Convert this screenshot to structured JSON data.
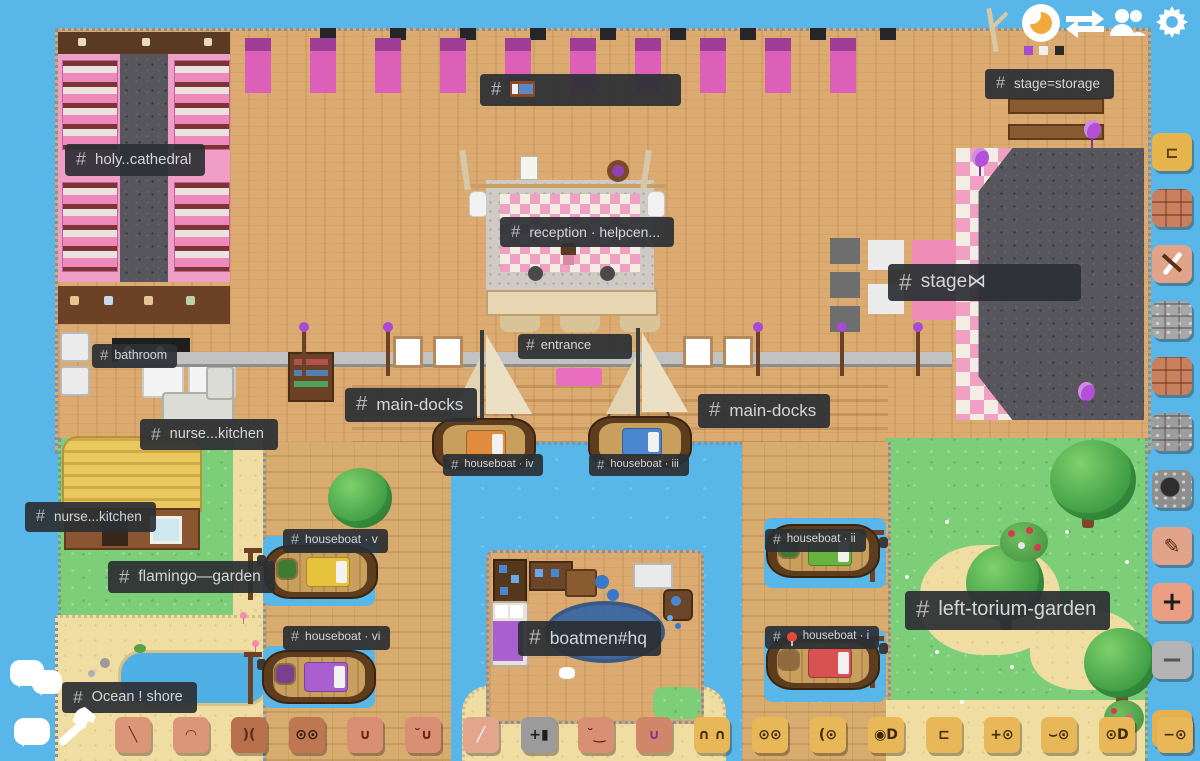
{
  "hash": "#",
  "topbar": {
    "buttons": [
      {
        "name": "night-mode",
        "icon": "crescent-moon-icon"
      },
      {
        "name": "map-swap",
        "icon": "transfer-arrows-icon"
      },
      {
        "name": "members",
        "icon": "people-icon"
      },
      {
        "name": "settings",
        "icon": "gear-icon"
      }
    ]
  },
  "map": {
    "labels": [
      {
        "id": "holy-cathedral",
        "text": "holy..cathedral"
      },
      {
        "id": "bedroom",
        "text": "🛏",
        "icon": "bed-emoji"
      },
      {
        "id": "stage-storage",
        "text": "stage=storage"
      },
      {
        "id": "reception-helpcenter",
        "text": "reception · helpcen..."
      },
      {
        "id": "stage",
        "text": "stage⋈"
      },
      {
        "id": "bathroom",
        "text": "bathroom"
      },
      {
        "id": "nurse-kitchen",
        "text": "nurse...kitchen"
      },
      {
        "id": "entrance",
        "text": "entrance"
      },
      {
        "id": "main-docks-left",
        "text": "main-docks"
      },
      {
        "id": "main-docks-right",
        "text": "main-docks"
      },
      {
        "id": "houseboat-iv",
        "text": "houseboat · iv"
      },
      {
        "id": "houseboat-iii",
        "text": "houseboat · iii"
      },
      {
        "id": "nurse-kitchen-west",
        "text": "nurse...kitchen"
      },
      {
        "id": "houseboat-v",
        "text": "houseboat · v"
      },
      {
        "id": "flamingo-garden",
        "text": "flamingo—garden"
      },
      {
        "id": "houseboat-ii",
        "text": "houseboat · ii"
      },
      {
        "id": "left-torium-garden",
        "text": "left-torium-garden"
      },
      {
        "id": "houseboat-vi",
        "text": "houseboat · vi"
      },
      {
        "id": "boatmen-hq",
        "text": "boatmen#hq"
      },
      {
        "id": "houseboat-i",
        "text": "houseboat · i",
        "emoji": "📍"
      },
      {
        "id": "ocean-shore",
        "text": "Ocean ! shore"
      }
    ],
    "boats": [
      {
        "id": "houseboat-iv",
        "type": "sailboat",
        "bed_color": "#e08b3e"
      },
      {
        "id": "houseboat-iii",
        "type": "sailboat",
        "bed_color": "#4a86cf"
      },
      {
        "id": "houseboat-v",
        "type": "rowboat",
        "bed_color": "#e6c23c"
      },
      {
        "id": "houseboat-ii",
        "type": "rowboat",
        "bed_color": "#67b33e"
      },
      {
        "id": "houseboat-vi",
        "type": "rowboat",
        "bed_color": "#a95fd0"
      },
      {
        "id": "houseboat-i",
        "type": "rowboat",
        "bed_color": "#d95252"
      }
    ]
  },
  "left_toolbar": {
    "buttons": [
      {
        "name": "chat-threads",
        "icon": "double-speech-bubble-icon"
      },
      {
        "name": "chat",
        "icon": "speech-bubble-icon"
      },
      {
        "name": "build-tool",
        "icon": "hammer-icon"
      }
    ]
  },
  "right_toolbar": {
    "buttons": [
      {
        "name": "active-tile",
        "glyph": "⊏",
        "color": "#e6b54d"
      },
      {
        "name": "brick-tile",
        "glyph": "",
        "color": "#c8805f"
      },
      {
        "name": "pickaxe-tile",
        "glyph": "",
        "color": "#e2a38b"
      },
      {
        "name": "stone-tile",
        "glyph": "",
        "color": "#a7a7a7"
      },
      {
        "name": "brick-tile-2",
        "glyph": "",
        "color": "#c8805f"
      },
      {
        "name": "stone-tile-2",
        "glyph": "",
        "color": "#9d9d9d"
      },
      {
        "name": "rubble-tile",
        "glyph": "",
        "color": "#8e8e8e"
      },
      {
        "name": "sign-tile",
        "glyph": "✎",
        "color": "#e2a38b"
      },
      {
        "name": "zoom-in",
        "glyph": "+",
        "color": "#eb9f82"
      },
      {
        "name": "zoom-out",
        "glyph": "−",
        "color": "#b4b4b4"
      },
      {
        "name": "face-tile",
        "glyph": "-D",
        "color": "#e6b04e"
      }
    ]
  },
  "bottom_toolbar": {
    "tiles": [
      {
        "name": "leaf-stroke-tile",
        "color": "#db9579",
        "glyph": "╲",
        "gc": "#6b2a18"
      },
      {
        "name": "arc-face-tile",
        "color": "#db9579",
        "glyph": "◠",
        "gc": "#6b2a18"
      },
      {
        "name": "bark-tile",
        "color": "#b76f4c",
        "glyph": ")(",
        "gc": "#5e2c16"
      },
      {
        "name": "owl-eyes-face-tile",
        "color": "#bd7852",
        "glyph": "⊙⊙",
        "gc": "#2e1608"
      },
      {
        "name": "grin-face-tile",
        "color": "#d98f73",
        "glyph": "∪",
        "gc": "#5e2414"
      },
      {
        "name": "wink-face-tile",
        "color": "#d98f73",
        "glyph": "˘∪",
        "gc": "#5e2414"
      },
      {
        "name": "bandage-face-tile",
        "color": "#e3a68c",
        "glyph": "╱",
        "gc": "#ffffff"
      },
      {
        "name": "anvil-counter-tile",
        "color": "#9b9b9b",
        "glyph": "+▮",
        "gc": "#1d1d1d"
      },
      {
        "name": "smirk-face-tile",
        "color": "#d98f73",
        "glyph": "˘‿",
        "gc": "#5e2414"
      },
      {
        "name": "tongue-face-tile",
        "color": "#cf8669",
        "glyph": "∪",
        "gc": "#8a2f8f"
      },
      {
        "name": "calm-face-tile",
        "color": "#e8b758",
        "glyph": "∩ ∩",
        "gc": "#3f2a08"
      },
      {
        "name": "round-eyes-face-tile",
        "color": "#e8b758",
        "glyph": "⊙⊙",
        "gc": "#3f2a08"
      },
      {
        "name": "wink-eye-face-tile",
        "color": "#e8b758",
        "glyph": "(⊙",
        "gc": "#3f2a08"
      },
      {
        "name": "big-eyes-face-tile",
        "color": "#e8b758",
        "glyph": "◉D",
        "gc": "#3f2a08"
      },
      {
        "name": "blank-face-tile",
        "color": "#e8b758",
        "glyph": "⊏",
        "gc": "#3f2a08"
      },
      {
        "name": "glance-face-tile",
        "color": "#e8b758",
        "glyph": "+⊙",
        "gc": "#3f2a08"
      },
      {
        "name": "teary-face-tile",
        "color": "#e8b758",
        "glyph": "⌣⊙",
        "gc": "#3f2a08"
      },
      {
        "name": "happy-face-tile",
        "color": "#e8b758",
        "glyph": "⊙D",
        "gc": "#3f2a08"
      },
      {
        "name": "sleepy-face-tile",
        "color": "#e8b758",
        "glyph": "−⊙",
        "gc": "#3f2a08"
      }
    ]
  },
  "colors": {
    "water": "#58b7e8",
    "wood": "#dcab72",
    "grass": "#7ccf78",
    "sand": "#efdda2",
    "label_bg": "#2c2f34",
    "label_text": "#d5d6d8",
    "edge_rope": "#7e93a4",
    "bed_pink": "#dc5fb8",
    "balloon_purple": "#b44fd8"
  }
}
